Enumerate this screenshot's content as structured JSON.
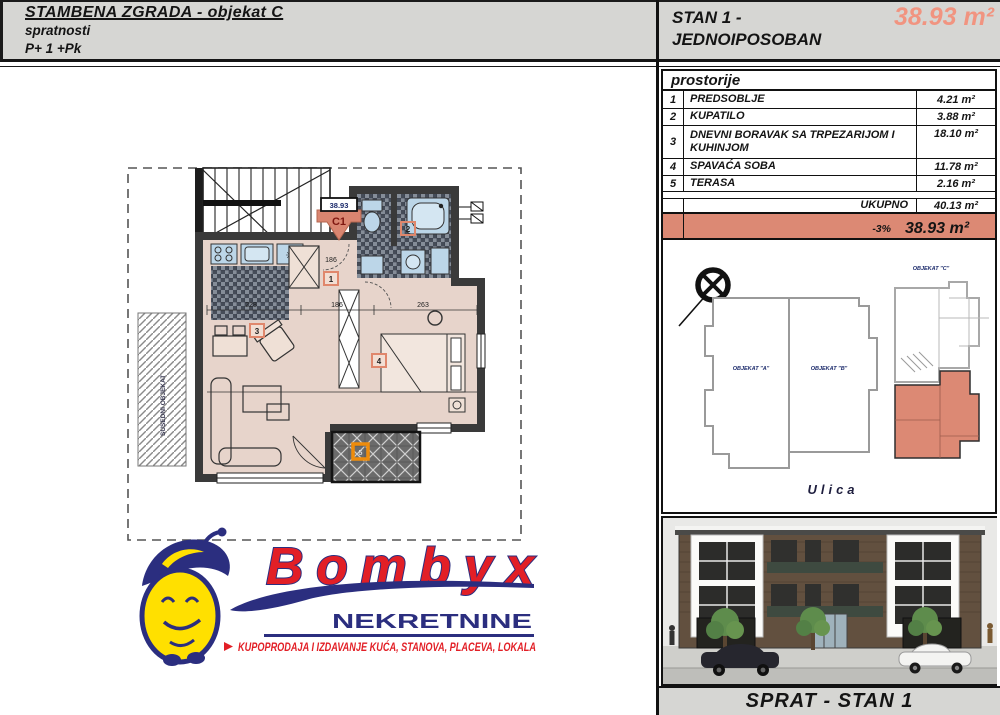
{
  "header_left": {
    "title": "STAMBENA ZGRADA - objekat C",
    "subtitle": "spratnosti",
    "floors": "P+ 1 +Pk"
  },
  "header_right": {
    "title_line1": "STAN 1 -",
    "title_line2": "JEDNOIPOSOBAN",
    "area": "38.93 m²"
  },
  "rooms_table": {
    "caption": "prostorije",
    "rows": [
      {
        "num": "1",
        "name": "PREDSOBLJE",
        "area": "4.21 m²"
      },
      {
        "num": "2",
        "name": "KUPATILO",
        "area": "3.88 m²"
      },
      {
        "num": "3",
        "name": "DNEVNI BORAVAK SA TRPEZARIJOM I KUHINJOM",
        "area": "18.10 m²"
      },
      {
        "num": "4",
        "name": "SPAVAĆA SOBA",
        "area": "11.78 m²"
      },
      {
        "num": "5",
        "name": "TERASA",
        "area": "2.16 m²"
      }
    ],
    "total_label": "UKUPNO",
    "total_area": "40.13 m²",
    "discount_label": "-3%",
    "discount_area": "38.93 m²"
  },
  "floorplan": {
    "unit_code": "C1",
    "unit_area": "38.93",
    "badges": [
      "1",
      "2",
      "3",
      "4",
      "5"
    ],
    "dim_hall": "186",
    "dim_living": "228",
    "dim_mid": "186",
    "dim_bedroom": "263",
    "side_label": "SUSEDNI OBJEKAT"
  },
  "siteplan": {
    "building_a": "OBJEKAT \"A\"",
    "building_b": "OBJEKAT \"B\"",
    "building_c": "OBJEKAT \"C\"",
    "street": "Ulica"
  },
  "logo": {
    "brand": "Bombyx",
    "subtitle": "NEKRETNINE",
    "tagline": "KUPOPRODAJA I IZDAVANJE KUĆA, STANOVA, PLACEVA, LOKALA"
  },
  "footer": {
    "label": "SPRAT - STAN 1"
  },
  "colors": {
    "accent_salmon": "#DC8974",
    "area_text_salmon": "#F19480",
    "terrace_badge_orange": "#EE8C0C",
    "logo_red": "#E21F26",
    "logo_navy": "#2B2E7F",
    "logo_yellow": "#FFE000"
  }
}
